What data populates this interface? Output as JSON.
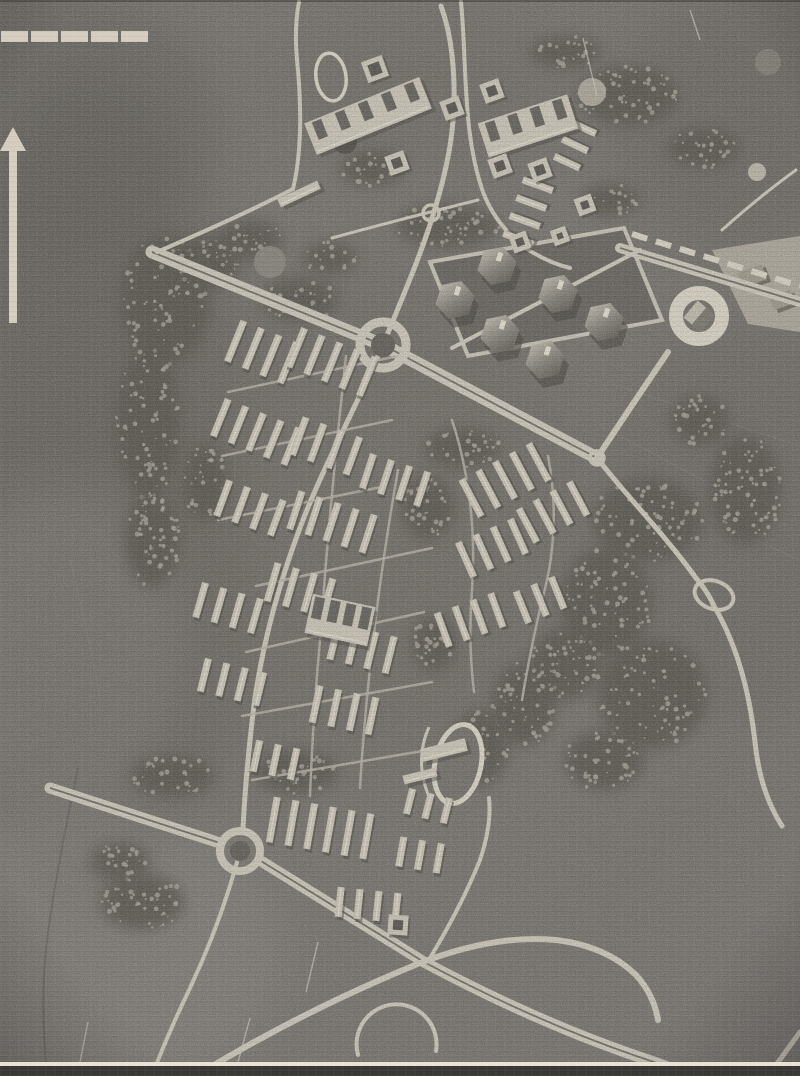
{
  "figure": {
    "kind": "aerial-photograph-of-urban-plan-model",
    "visible_text": [],
    "plate": {
      "edge_line_y": 1062,
      "edge_line_h": 4,
      "dark_strip_h": 10
    }
  },
  "palette": {
    "paper_bg": "#7e7a75",
    "road_light": "#d2ccbf",
    "road_bright": "#ded8ca",
    "street_light": "#bdb7ab",
    "building_light": "#d0cabd",
    "building_bright": "#e8e2d4",
    "shadow_dark": "#514e49",
    "slot_dark": "#5b5853",
    "tree_dark": "#605d57",
    "speckle_light": "#a9a399",
    "median_dark": "#6d6a65",
    "plate_white": "#e8e2d4",
    "plate_dark": "#3a3835",
    "marker_cream": "#d5cec0"
  },
  "markers": {
    "scale_bar": {
      "segments": 5,
      "x": 1,
      "y": 31,
      "seg_w": 27,
      "seg_h": 11,
      "gap": 3
    },
    "north_arrow": {
      "tip_x": 13,
      "tip_y": 127,
      "head_half_w": 13,
      "head_h": 24,
      "shaft_w": 8,
      "shaft_top": 148,
      "shaft_bottom": 323
    }
  },
  "map": {
    "tones": [
      [
        90,
        500,
        150,
        430,
        "#6a6661",
        0.65
      ],
      [
        60,
        120,
        160,
        130,
        "#6b6762",
        0.55
      ],
      [
        740,
        120,
        130,
        140,
        "#6e6a65",
        0.5
      ],
      [
        360,
        520,
        240,
        270,
        "#747069",
        0.45
      ],
      [
        740,
        520,
        140,
        210,
        "#716d68",
        0.5
      ],
      [
        90,
        950,
        190,
        150,
        "#8d8984",
        0.6
      ],
      [
        60,
        650,
        130,
        170,
        "#8a8580",
        0.5
      ],
      [
        760,
        980,
        140,
        130,
        "#878380",
        0.5
      ],
      [
        430,
        90,
        160,
        90,
        "#747069",
        0.45
      ],
      [
        700,
        900,
        120,
        160,
        "#7b7772",
        0.5
      ]
    ],
    "field_lines": [
      "M612,384 L800,446",
      "M598,424 L788,526",
      "M636,486 L800,560",
      "M70,560 Q90,640 100,700"
    ],
    "stream": "M78,768 Q58,862 48,932 Q40,992 46,1062",
    "tree_patches": [
      [
        165,
        300,
        45,
        65
      ],
      [
        208,
        262,
        32,
        26
      ],
      [
        148,
        424,
        32,
        75
      ],
      [
        152,
        540,
        28,
        48
      ],
      [
        205,
        482,
        22,
        38
      ],
      [
        250,
        240,
        32,
        20
      ],
      [
        300,
        300,
        38,
        22
      ],
      [
        372,
        168,
        32,
        18
      ],
      [
        330,
        258,
        26,
        16
      ],
      [
        448,
        226,
        52,
        22
      ],
      [
        610,
        200,
        30,
        16
      ],
      [
        462,
        448,
        38,
        20
      ],
      [
        428,
        508,
        26,
        32
      ],
      [
        648,
        520,
        55,
        42
      ],
      [
        606,
        602,
        46,
        55
      ],
      [
        652,
        694,
        55,
        55
      ],
      [
        566,
        664,
        36,
        36
      ],
      [
        524,
        704,
        32,
        42
      ],
      [
        604,
        760,
        40,
        30
      ],
      [
        480,
        748,
        28,
        38
      ],
      [
        434,
        644,
        22,
        28
      ],
      [
        296,
        772,
        42,
        22
      ],
      [
        172,
        776,
        42,
        20
      ],
      [
        142,
        902,
        42,
        28
      ],
      [
        120,
        862,
        30,
        20
      ],
      [
        628,
        96,
        50,
        30
      ],
      [
        704,
        148,
        36,
        20
      ],
      [
        566,
        52,
        36,
        16
      ],
      [
        745,
        490,
        36,
        55
      ],
      [
        700,
        420,
        30,
        25
      ]
    ],
    "discs": [
      [
        270,
        262,
        16,
        "#908c85"
      ],
      [
        345,
        142,
        12,
        "#57534e"
      ],
      [
        592,
        92,
        14,
        "#b6b0a3"
      ],
      [
        768,
        62,
        13,
        "#8a8680"
      ],
      [
        757,
        172,
        9,
        "#c5bfb2"
      ]
    ],
    "roads": [
      {
        "name": "nw-avenue",
        "d": "M152,252 L383,345",
        "w": 13,
        "dual": true
      },
      {
        "name": "central-avenue",
        "d": "M383,345 L597,458",
        "w": 13,
        "dual": true
      },
      {
        "name": "ne-boulevard-link",
        "d": "M597,458 Q630,408 668,352",
        "w": 6,
        "dual": false
      },
      {
        "name": "ring-boulevard",
        "d": "M620,248 L800,302",
        "w": 10,
        "dual": true
      },
      {
        "name": "north-road",
        "d": "M383,345 C402,298 420,258 434,212 C448,166 459,118 452,55 Q449,28 441,6",
        "w": 5,
        "dual": false
      },
      {
        "name": "top-left-road",
        "d": "M157,252 Q245,214 293,189 Q305,138 297,60 Q294,28 299,2",
        "w": 4,
        "dual": false
      },
      {
        "name": "top-right-road",
        "d": "M461,2 C467,62 462,132 483,192 Q496,226 527,249 Q549,263 570,268",
        "w": 4,
        "dual": false
      },
      {
        "name": "minor-cross-top",
        "d": "M332,238 Q390,222 478,200",
        "w": 3,
        "dual": false
      },
      {
        "name": "southwest-spine",
        "d": "M383,345 C352,415 323,468 303,520 C281,577 263,640 254,705 Q246,770 243,828",
        "w": 5,
        "dual": false
      },
      {
        "name": "west-dual",
        "d": "M50,788 Q142,818 220,843",
        "w": 11,
        "dual": true
      },
      {
        "name": "southeast-dual",
        "d": "M261,861 L424,962 Q540,1024 648,1060 Q672,1068 688,1076",
        "w": 11,
        "dual": true
      },
      {
        "name": "lowland-cross-road",
        "d": "M196,1076 Q300,1012 420,963 Q496,934 556,940 Q606,946 636,975 Q654,995 658,1020",
        "w": 6,
        "dual": false
      },
      {
        "name": "branch-north-from-crossing",
        "d": "M430,958 Q462,905 480,860 Q492,824 489,798",
        "w": 4,
        "dual": false
      },
      {
        "name": "sw-branch",
        "d": "M240,851 Q222,920 190,988 Q166,1038 152,1076",
        "w": 4,
        "dual": false
      },
      {
        "name": "east-road",
        "d": "M597,458 C625,494 664,534 696,578 Q708,592 714,606",
        "w": 5,
        "dual": false
      },
      {
        "name": "east-road-south",
        "d": "M714,606 Q746,660 755,742 Q760,792 782,826",
        "w": 5,
        "dual": false
      },
      {
        "name": "top-right-faint-road",
        "d": "M796,170 Q760,196 722,230",
        "w": 3,
        "dual": false
      },
      {
        "name": "bottom-right-diagonal",
        "d": "M768,1076 L800,1032",
        "w": 5,
        "dual": false
      },
      {
        "name": "bottom-loop-arc",
        "d": "M358,1055 A40,40 0 1 1 436,1051",
        "w": 4,
        "dual": false
      },
      {
        "name": "superblock-diagonal",
        "d": "M452,348 L640,250",
        "w": 4,
        "dual": false
      }
    ],
    "streets": [
      "M228,392 L398,356",
      "M222,456 L392,420",
      "M218,520 L386,486",
      "M256,586 L432,548",
      "M246,652 L424,612",
      "M242,716 L432,682",
      "M252,780 L452,746",
      "M346,356 Q330,500 320,640 Q313,718 310,796",
      "M398,470 Q382,560 372,650 Q364,720 360,788",
      "M452,420 Q478,500 472,590 Q468,642 474,692",
      "M548,456 Q562,530 542,600 Q530,652 522,700"
    ],
    "dashes": [
      {
        "name": "boulevard-platform-slabs",
        "d": "M632,234 L800,286",
        "w": 6,
        "dash": "16 9"
      }
    ],
    "junctions": [
      [
        431,
        213,
        8
      ],
      [
        597,
        458,
        7
      ]
    ],
    "roundabouts": [
      {
        "name": "central-roundabout",
        "cx": 383,
        "cy": 345,
        "r": 23,
        "ring_w": 9,
        "core_r": 12
      },
      {
        "name": "southwest-roundabout",
        "cx": 240,
        "cy": 851,
        "r": 20,
        "ring_w": 8,
        "core_r": 10
      }
    ],
    "ring_interchange": {
      "cx": 699,
      "cy": 316,
      "r": 23,
      "ring_w": 14,
      "core_r": 16,
      "diamond_s": 22,
      "diamond_rot": 40
    },
    "east_loop": {
      "cx": 714,
      "cy": 595,
      "rx": 20,
      "ry": 14,
      "rot": 20,
      "w": 4
    },
    "superblock": {
      "points": "430,262 624,228 662,320 468,356",
      "fill": "#6f6b66"
    },
    "plaza": {
      "points": "712,250 800,236 800,332 748,324",
      "fill": "#b5afa2",
      "blocks": [
        [
          752,
          276,
          26,
          16,
          -20
        ],
        [
          782,
          300,
          22,
          14,
          -20
        ]
      ]
    },
    "stadiums": [
      {
        "name": "stadium-track",
        "cx": 458,
        "cy": 764,
        "rx": 23,
        "ry": 40,
        "rot": 12,
        "w": 5
      },
      {
        "name": "north-oval-track",
        "cx": 331,
        "cy": 77,
        "rx": 15,
        "ry": 24,
        "rot": -8,
        "w": 3.5
      }
    ],
    "stadium_arc": "M429,727 Q413,763 431,801",
    "clusters": [
      [
        262,
        352,
        22,
        4,
        44
      ],
      [
        332,
        362,
        22,
        5,
        42
      ],
      [
        256,
        432,
        22,
        5,
        40
      ],
      [
        326,
        446,
        20,
        4,
        40
      ],
      [
        250,
        508,
        20,
        4,
        38
      ],
      [
        332,
        522,
        18,
        5,
        40
      ],
      [
        395,
        480,
        18,
        4,
        36
      ],
      [
        300,
        590,
        16,
        4,
        40
      ],
      [
        228,
        608,
        16,
        4,
        36
      ],
      [
        362,
        648,
        14,
        4,
        38
      ],
      [
        232,
        682,
        14,
        4,
        34
      ],
      [
        344,
        710,
        12,
        4,
        38
      ],
      [
        275,
        760,
        12,
        3,
        32
      ],
      [
        320,
        828,
        10,
        6,
        46
      ],
      [
        420,
        855,
        10,
        3,
        30
      ],
      [
        368,
        905,
        6,
        4,
        30
      ],
      [
        505,
        480,
        -28,
        5,
        42
      ],
      [
        553,
        512,
        -28,
        4,
        38
      ],
      [
        492,
        548,
        -24,
        4,
        38
      ],
      [
        540,
        600,
        -22,
        3,
        34
      ],
      [
        470,
        620,
        -20,
        4,
        36
      ],
      [
        528,
        212,
        -70,
        4,
        32
      ],
      [
        575,
        145,
        -65,
        3,
        28
      ],
      [
        428,
        806,
        14,
        3,
        26
      ]
    ],
    "slab": {
      "w": 7,
      "gap": 12
    },
    "large_buildings": [
      [
        368,
        116,
        124,
        34,
        -22,
        5
      ],
      [
        528,
        126,
        94,
        36,
        -18,
        4
      ],
      [
        340,
        620,
        64,
        40,
        12,
        4
      ],
      [
        299,
        194,
        44,
        9,
        -25,
        0
      ],
      [
        444,
        750,
        46,
        13,
        -14,
        0
      ],
      [
        420,
        776,
        34,
        9,
        -14,
        0
      ]
    ],
    "courtyards": [
      [
        375,
        69,
        22,
        -20
      ],
      [
        397,
        163,
        20,
        -20
      ],
      [
        452,
        108,
        20,
        -20
      ],
      [
        492,
        91,
        20,
        -20
      ],
      [
        500,
        166,
        20,
        -20
      ],
      [
        540,
        170,
        20,
        -20
      ],
      [
        585,
        205,
        18,
        -20
      ],
      [
        398,
        925,
        20,
        4
      ],
      [
        520,
        242,
        18,
        -20
      ],
      [
        560,
        236,
        16,
        -20
      ]
    ],
    "towers": {
      "r": 20,
      "rot": 18,
      "positions": [
        [
          455,
          300
        ],
        [
          497,
          266
        ],
        [
          500,
          334
        ],
        [
          558,
          294
        ],
        [
          545,
          360
        ],
        [
          604,
          322
        ]
      ]
    },
    "scratches": [
      [
        583,
        38,
        597,
        96
      ],
      [
        88,
        1022,
        80,
        1062
      ],
      [
        250,
        1018,
        238,
        1062
      ],
      [
        318,
        942,
        306,
        992
      ],
      [
        690,
        10,
        700,
        40
      ]
    ]
  }
}
